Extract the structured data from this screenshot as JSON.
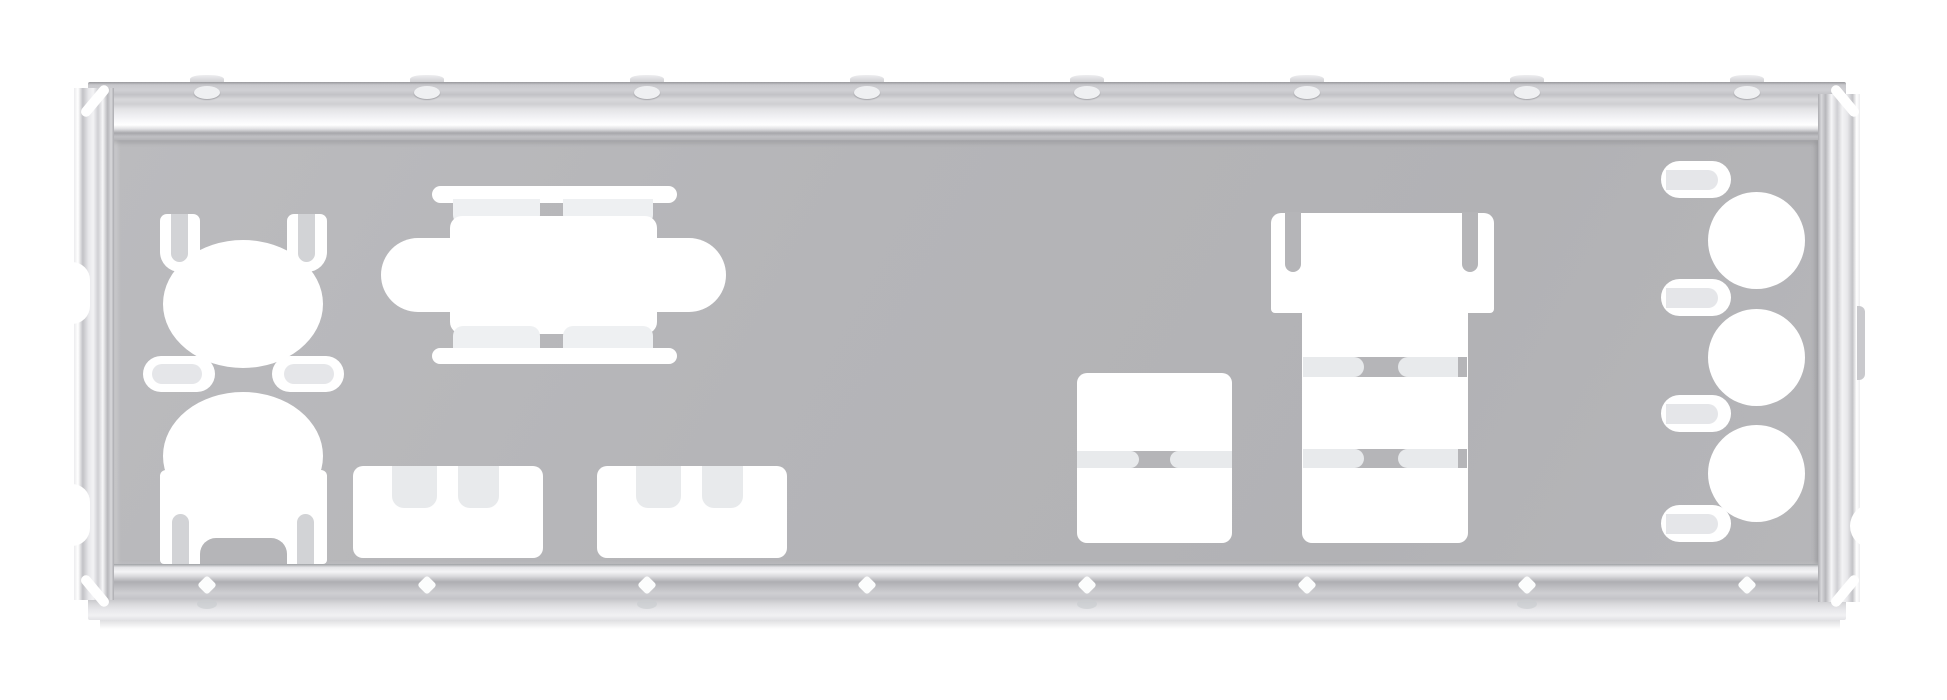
{
  "image": {
    "subject": "Motherboard rear I/O shield blanking plate",
    "style": "product photograph, face-on, plain white background",
    "material": "stamped sheet metal, matte silver-gray"
  },
  "colors": {
    "background": "#ffffff",
    "plate_face": "#b6b6b9",
    "cutout_fill": "#ffffff",
    "bent_tab_light": "#e8eaec",
    "bent_tab_mid": "#d2d3d6",
    "rail_highlight": "#ffffff",
    "rail_shadow": "#97979b"
  },
  "features": {
    "top_rail": {
      "label": "Top mounting rail with stamped ridges",
      "rivet_count": 8
    },
    "bottom_rail": {
      "label": "Bottom mounting rail with stamped ridges",
      "rivet_count": 8
    },
    "left_fold": {
      "label": "Left folded mounting edge",
      "notch_count": 2
    },
    "right_fold": {
      "label": "Right folded mounting edge",
      "notch_count": 2
    },
    "cutouts": {
      "ps2_upper": {
        "label": "Upper round port cutout with grounding tabs"
      },
      "ps2_lower": {
        "label": "Lower round port cutout with grounding tabs"
      },
      "clip_left": {
        "label": "Left retention clip slot"
      },
      "clip_right": {
        "label": "Right retention clip slot"
      },
      "dsub": {
        "label": "D-sub connector cutout with screw slots and fold-in tabs"
      },
      "usb_block_left": {
        "label": "USB pair cutout left with fold-in tabs"
      },
      "usb_block_right": {
        "label": "USB pair cutout right with fold-in tabs"
      },
      "usb_stack_middle": {
        "label": "Stacked dual USB cutout with separator tabs"
      },
      "lan_usb_cluster": {
        "label": "LAN over stacked USB cluster cutout with hook tabs"
      },
      "audio_jacks": {
        "label": "Round audio jack cutouts",
        "jack_count": 3,
        "spring_tab_count": 4
      }
    }
  }
}
